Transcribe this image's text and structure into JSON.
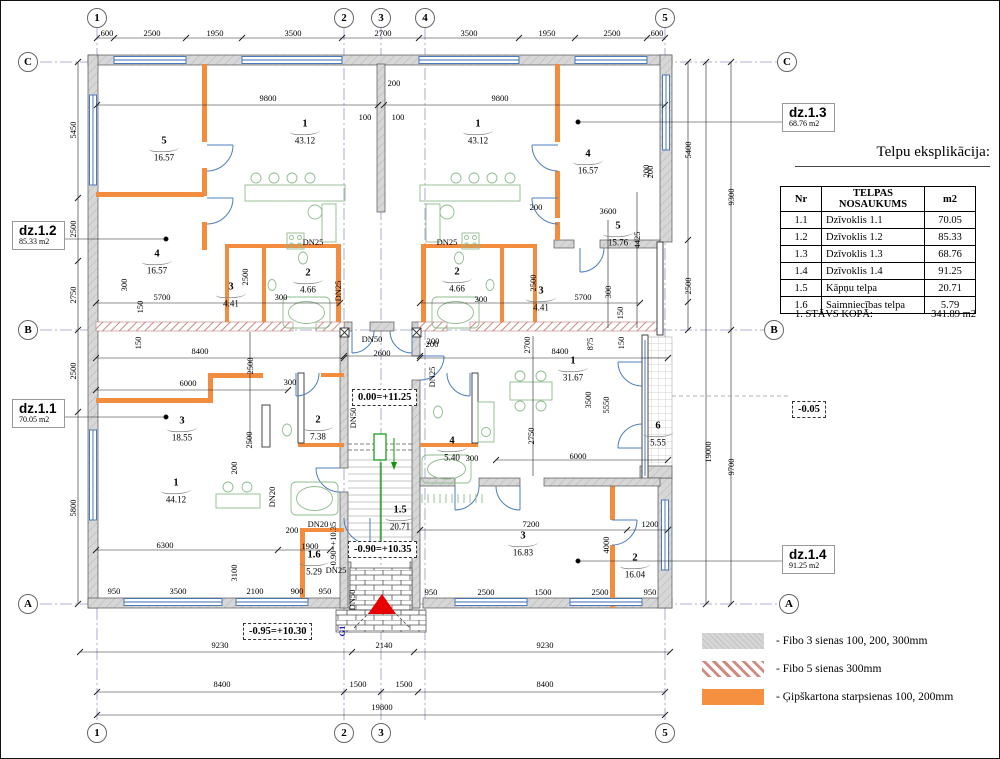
{
  "table": {
    "title": "Telpu eksplikācija:",
    "headers": [
      "Nr",
      "TELPAS NOSAUKUMS",
      "m2"
    ],
    "rows": [
      [
        "1.1",
        "Dzīvoklis 1.1",
        "70.05"
      ],
      [
        "1.2",
        "Dzīvoklis 1.2",
        "85.33"
      ],
      [
        "1.3",
        "Dzīvoklis 1.3",
        "68.76"
      ],
      [
        "1.4",
        "Dzīvoklis 1.4",
        "91.25"
      ],
      [
        "1.5",
        "Kāpņu telpa",
        "20.71"
      ],
      [
        "1.6",
        "Saimniecības telpa",
        "5.79"
      ]
    ],
    "total_label": "1. STĀVS KOPĀ:",
    "total_value": "341.89 m2"
  },
  "legend": {
    "items": [
      {
        "key": "fibo3",
        "label": "- Fibo 3 sienas 100, 200, 300mm"
      },
      {
        "key": "fibo5",
        "label": "- Fibo 5 sienas 300mm"
      },
      {
        "key": "gips",
        "label": "- Ģipškartona starpsienas 100, 200mm"
      }
    ]
  },
  "annotations": {
    "dz12": {
      "name": "dz.1.2",
      "area": "85.33 m2"
    },
    "dz11": {
      "name": "dz.1.1",
      "area": "70.05 m2"
    },
    "dz13": {
      "name": "dz.1.3",
      "area": "68.76 m2"
    },
    "dz14": {
      "name": "dz.1.4",
      "area": "91.25 m2"
    },
    "levels": {
      "stair_top": "0.00=+11.25",
      "stair_bottom": "-0.90=+10.35",
      "porch": "-0.95=+10.30",
      "terrace": "-0.05"
    }
  },
  "plan": {
    "grid_bubbles": [
      {
        "t": "1",
        "x": 97,
        "y": 18
      },
      {
        "t": "2",
        "x": 344,
        "y": 18
      },
      {
        "t": "3",
        "x": 381,
        "y": 18
      },
      {
        "t": "4",
        "x": 425,
        "y": 18
      },
      {
        "t": "5",
        "x": 665,
        "y": 18
      },
      {
        "t": "1",
        "x": 97,
        "y": 733
      },
      {
        "t": "2",
        "x": 344,
        "y": 733
      },
      {
        "t": "3",
        "x": 381,
        "y": 733
      },
      {
        "t": "5",
        "x": 665,
        "y": 733
      },
      {
        "t": "C",
        "x": 28,
        "y": 62
      },
      {
        "t": "B",
        "x": 28,
        "y": 330
      },
      {
        "t": "A",
        "x": 28,
        "y": 604
      },
      {
        "t": "C",
        "x": 787,
        "y": 62
      },
      {
        "t": "B",
        "x": 774,
        "y": 330
      },
      {
        "t": "A",
        "x": 789,
        "y": 604
      }
    ],
    "rooms": [
      {
        "n": "5",
        "a": "16.57",
        "x": 164,
        "y": 148
      },
      {
        "n": "1",
        "a": "43.12",
        "x": 305,
        "y": 131
      },
      {
        "n": "4",
        "a": "16.57",
        "x": 157,
        "y": 261
      },
      {
        "n": "3",
        "a": "4.41",
        "x": 231,
        "y": 294
      },
      {
        "n": "2",
        "a": "4.66",
        "x": 308,
        "y": 280
      },
      {
        "n": "1",
        "a": "43.12",
        "x": 478,
        "y": 131
      },
      {
        "n": "4",
        "a": "16.57",
        "x": 588,
        "y": 161
      },
      {
        "n": "5",
        "a": "15.76",
        "x": 618,
        "y": 233
      },
      {
        "n": "2",
        "a": "4.66",
        "x": 457,
        "y": 279
      },
      {
        "n": "3",
        "a": "4.41",
        "x": 541,
        "y": 298
      },
      {
        "n": "3",
        "a": "18.55",
        "x": 182,
        "y": 428
      },
      {
        "n": "2",
        "a": "7.38",
        "x": 318,
        "y": 427
      },
      {
        "n": "1",
        "a": "44.12",
        "x": 176,
        "y": 490
      },
      {
        "n": "1.6",
        "a": "5.29",
        "x": 314,
        "y": 562
      },
      {
        "n": "1.5",
        "a": "20.71",
        "x": 400,
        "y": 517
      },
      {
        "n": "1",
        "a": "31.67",
        "x": 573,
        "y": 368
      },
      {
        "n": "6",
        "a": "5.55",
        "x": 658,
        "y": 433
      },
      {
        "n": "4",
        "a": "5.40",
        "x": 452,
        "y": 448
      },
      {
        "n": "3",
        "a": "16.83",
        "x": 523,
        "y": 543
      },
      {
        "n": "2",
        "a": "16.04",
        "x": 635,
        "y": 565
      }
    ],
    "dims": [
      {
        "t": "600",
        "x": 107,
        "y": 33
      },
      {
        "t": "2500",
        "x": 152,
        "y": 33
      },
      {
        "t": "1950",
        "x": 215,
        "y": 33
      },
      {
        "t": "3500",
        "x": 293,
        "y": 33
      },
      {
        "t": "2700",
        "x": 383,
        "y": 33
      },
      {
        "t": "3500",
        "x": 469,
        "y": 33
      },
      {
        "t": "1950",
        "x": 547,
        "y": 33
      },
      {
        "t": "2500",
        "x": 612,
        "y": 33
      },
      {
        "t": "600",
        "x": 657,
        "y": 33
      },
      {
        "t": "5450",
        "x": 73,
        "y": 130,
        "r": 1
      },
      {
        "t": "2500",
        "x": 73,
        "y": 229,
        "r": 1
      },
      {
        "t": "2750",
        "x": 73,
        "y": 295,
        "r": 1
      },
      {
        "t": "2500",
        "x": 73,
        "y": 371,
        "r": 1
      },
      {
        "t": "5800",
        "x": 73,
        "y": 508,
        "r": 1
      },
      {
        "t": "5400",
        "x": 688,
        "y": 150,
        "r": 1
      },
      {
        "t": "2500",
        "x": 688,
        "y": 286,
        "r": 1
      },
      {
        "t": "9300",
        "x": 731,
        "y": 197,
        "r": 1
      },
      {
        "t": "9700",
        "x": 731,
        "y": 467,
        "r": 1
      },
      {
        "t": "19000",
        "x": 708,
        "y": 452,
        "r": 1
      },
      {
        "t": "200",
        "x": 650,
        "y": 172,
        "r": 1
      },
      {
        "t": "950",
        "x": 114,
        "y": 591
      },
      {
        "t": "3500",
        "x": 178,
        "y": 591
      },
      {
        "t": "2100",
        "x": 255,
        "y": 591
      },
      {
        "t": "900",
        "x": 297,
        "y": 591
      },
      {
        "t": "950",
        "x": 325,
        "y": 591
      },
      {
        "t": "950",
        "x": 431,
        "y": 592
      },
      {
        "t": "2500",
        "x": 486,
        "y": 592
      },
      {
        "t": "1500",
        "x": 543,
        "y": 592
      },
      {
        "t": "2500",
        "x": 600,
        "y": 592
      },
      {
        "t": "950",
        "x": 650,
        "y": 592
      },
      {
        "t": "9230",
        "x": 220,
        "y": 645
      },
      {
        "t": "2140",
        "x": 384,
        "y": 645
      },
      {
        "t": "9230",
        "x": 545,
        "y": 645
      },
      {
        "t": "8400",
        "x": 222,
        "y": 684
      },
      {
        "t": "1500",
        "x": 358,
        "y": 684
      },
      {
        "t": "1500",
        "x": 404,
        "y": 684
      },
      {
        "t": "8400",
        "x": 545,
        "y": 684
      },
      {
        "t": "19800",
        "x": 382,
        "y": 707
      },
      {
        "t": "9800",
        "x": 268,
        "y": 98
      },
      {
        "t": "9800",
        "x": 500,
        "y": 98
      },
      {
        "t": "200",
        "x": 394,
        "y": 83
      },
      {
        "t": "100",
        "x": 365,
        "y": 117
      },
      {
        "t": "100",
        "x": 398,
        "y": 117
      },
      {
        "t": "300",
        "x": 124,
        "y": 285,
        "r": 1
      },
      {
        "t": "150",
        "x": 140,
        "y": 307,
        "r": 1
      },
      {
        "t": "5700",
        "x": 162,
        "y": 297
      },
      {
        "t": "2500",
        "x": 245,
        "y": 277,
        "r": 1
      },
      {
        "t": "300",
        "x": 281,
        "y": 297
      },
      {
        "t": "DN25",
        "x": 313,
        "y": 242
      },
      {
        "t": "DN25",
        "x": 338,
        "y": 291,
        "r": 1
      },
      {
        "t": "200",
        "x": 536,
        "y": 207
      },
      {
        "t": "3600",
        "x": 608,
        "y": 211
      },
      {
        "t": "4425",
        "x": 637,
        "y": 240,
        "r": 1
      },
      {
        "t": "300",
        "x": 481,
        "y": 299
      },
      {
        "t": "2500",
        "x": 533,
        "y": 283,
        "r": 1
      },
      {
        "t": "5700",
        "x": 583,
        "y": 297
      },
      {
        "t": "300",
        "x": 608,
        "y": 292,
        "r": 1
      },
      {
        "t": "150",
        "x": 620,
        "y": 313,
        "r": 1
      },
      {
        "t": "200",
        "x": 646,
        "y": 171,
        "r": 1
      },
      {
        "t": "DN25",
        "x": 447,
        "y": 242
      },
      {
        "t": "DN50",
        "x": 372,
        "y": 339
      },
      {
        "t": "2600",
        "x": 382,
        "y": 353
      },
      {
        "t": "200",
        "x": 433,
        "y": 341
      },
      {
        "t": "DN25",
        "x": 432,
        "y": 377,
        "r": 1
      },
      {
        "t": "DN50",
        "x": 353,
        "y": 418,
        "r": 1
      },
      {
        "t": "150",
        "x": 138,
        "y": 343,
        "r": 1
      },
      {
        "t": "8400",
        "x": 200,
        "y": 351
      },
      {
        "t": "8400",
        "x": 560,
        "y": 351
      },
      {
        "t": "200",
        "x": 432,
        "y": 344
      },
      {
        "t": "2700",
        "x": 527,
        "y": 345,
        "r": 1
      },
      {
        "t": "875",
        "x": 590,
        "y": 344,
        "r": 1
      },
      {
        "t": "150",
        "x": 621,
        "y": 343,
        "r": 1
      },
      {
        "t": "2500",
        "x": 250,
        "y": 366,
        "r": 1
      },
      {
        "t": "6000",
        "x": 188,
        "y": 383
      },
      {
        "t": "300",
        "x": 290,
        "y": 382
      },
      {
        "t": "2500",
        "x": 249,
        "y": 440,
        "r": 1
      },
      {
        "t": "200",
        "x": 234,
        "y": 468,
        "r": 1
      },
      {
        "t": "DN20",
        "x": 272,
        "y": 497,
        "r": 1
      },
      {
        "t": "6300",
        "x": 165,
        "y": 545
      },
      {
        "t": "200",
        "x": 292,
        "y": 530
      },
      {
        "t": "1900",
        "x": 310,
        "y": 546
      },
      {
        "t": "3100",
        "x": 234,
        "y": 573,
        "r": 1
      },
      {
        "t": "DN20",
        "x": 318,
        "y": 524
      },
      {
        "t": "DN25",
        "x": 336,
        "y": 570
      },
      {
        "t": "-0.90=+10.35",
        "x": 333,
        "y": 545,
        "r": 1
      },
      {
        "t": "DN50",
        "x": 352,
        "y": 600,
        "r": 1
      },
      {
        "t": "G1",
        "x": 342,
        "y": 631,
        "r": 1,
        "blue": 1
      },
      {
        "t": "2750",
        "x": 531,
        "y": 436,
        "r": 1
      },
      {
        "t": "3500",
        "x": 588,
        "y": 400,
        "r": 1
      },
      {
        "t": "5550",
        "x": 606,
        "y": 405,
        "r": 1
      },
      {
        "t": "300",
        "x": 472,
        "y": 458
      },
      {
        "t": "6000",
        "x": 578,
        "y": 456
      },
      {
        "t": "7200",
        "x": 531,
        "y": 524
      },
      {
        "t": "1200",
        "x": 650,
        "y": 524
      },
      {
        "t": "4000",
        "x": 606,
        "y": 545,
        "r": 1
      }
    ]
  },
  "colors": {
    "wall_gray": "#d7d7d7",
    "fibo5_red": "#cf8a82",
    "partition_orange": "#f28c3e",
    "door_blue": "#4d7ebf",
    "fixture_green": "#8ebc8e",
    "grid_blue": "#9595cb",
    "arrow_red": "#e60000",
    "g1_blue": "#1a1acc"
  }
}
